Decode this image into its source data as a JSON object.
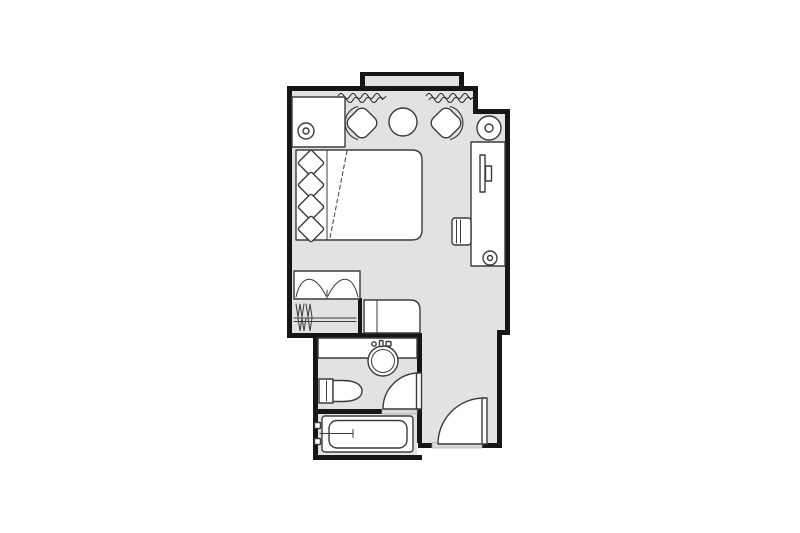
{
  "image": {
    "kind": "architectural-floor-plan",
    "subject": "hotel guest room with ensuite bathroom",
    "width_px": 800,
    "height_px": 533,
    "visible_text": ""
  },
  "colors": {
    "background": "#ffffff",
    "floor": "#e2e2e2",
    "wall": "#161616",
    "furniture_stroke": "#3c3c3c",
    "furniture_fill": "#ffffff",
    "threshold": "#d9d9d9",
    "curtain_line": "#2a2a2a"
  },
  "rooms": [
    {
      "name": "bedroom",
      "features": [
        "bay-window",
        "curtains"
      ]
    },
    {
      "name": "entry-corridor",
      "features": [
        "entry-door"
      ]
    },
    {
      "name": "bathroom",
      "features": [
        "sink",
        "toilet",
        "bathtub",
        "bathroom-door"
      ]
    },
    {
      "name": "closet",
      "features": [
        "bifold-doors",
        "clothes-rod",
        "hangers"
      ]
    }
  ],
  "furniture": [
    "nightstand-with-lamp",
    "armchair-left",
    "round-table",
    "armchair-right",
    "floor-lamp",
    "double-bed-with-four-pillows",
    "tv-console",
    "television",
    "desk-chair",
    "desk-lamp",
    "luggage-bench",
    "vanity-counter"
  ],
  "doors": [
    {
      "name": "entry-door",
      "swing": "quarter-circle-inward"
    },
    {
      "name": "bathroom-door",
      "swing": "quarter-circle-inward"
    },
    {
      "name": "closet-bifold-doors",
      "swing": "bifold"
    }
  ]
}
